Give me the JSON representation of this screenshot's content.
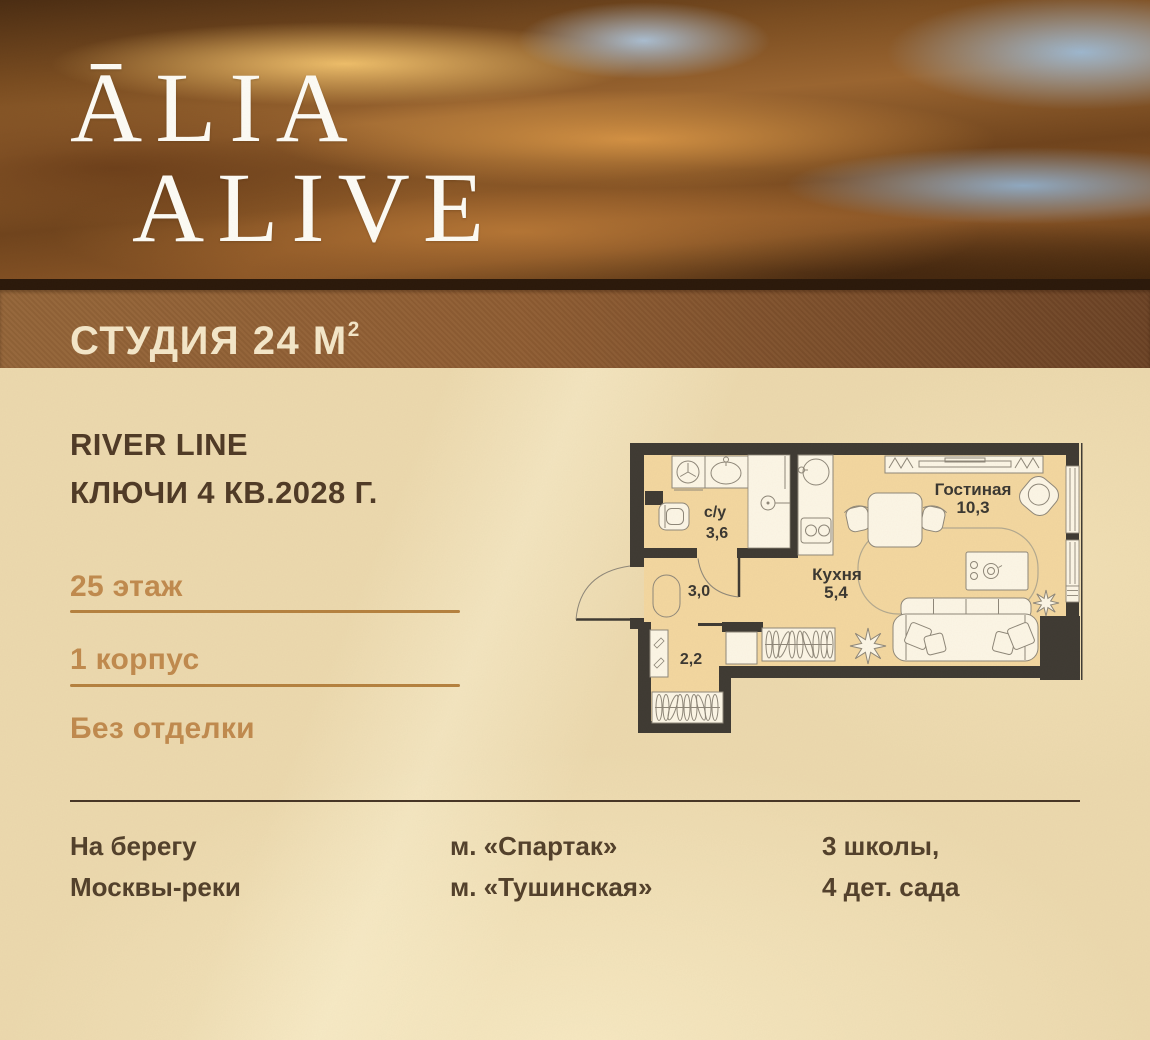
{
  "brand": {
    "line1": "ĀLIA",
    "line2": "ALIVE"
  },
  "banner": {
    "title": "СТУДИЯ 24 М",
    "sup": "2"
  },
  "details": {
    "project": "RIVER LINE",
    "keys": "КЛЮЧИ 4 КВ.2028 Г.",
    "floor": "25 этаж",
    "building": "1 корпус",
    "finish": "Без отделки"
  },
  "floorplan": {
    "bathroom": {
      "name": "с/у",
      "area": "3,6"
    },
    "hallway": {
      "area": "3,0"
    },
    "wardrobe": {
      "area": "2,2"
    },
    "kitchen": {
      "name": "Кухня",
      "area": "5,4"
    },
    "living": {
      "name": "Гостиная",
      "area": "10,3"
    }
  },
  "footer": {
    "columns": [
      {
        "line1": "На берегу",
        "line2": "Москвы-реки"
      },
      {
        "line1": "м. «Спартак»",
        "line2": "м. «Тушинская»"
      },
      {
        "line1": "3 школы,",
        "line2": "4 дет. сада"
      }
    ]
  },
  "colors": {
    "background_cream": "#ecd9ae",
    "band_brown": "#8e5c32",
    "band_text": "#f4e7c9",
    "heading_brown": "#4f3a26",
    "accent_bronze": "#c08a4e",
    "rule_bronze": "#b5813f",
    "footer_text": "#52402b",
    "plan_wall": "#3e3a33",
    "plan_floor": "#f3d7a0",
    "plan_fixture": "#fcf6e6",
    "logo_white": "#fdfcf6"
  }
}
